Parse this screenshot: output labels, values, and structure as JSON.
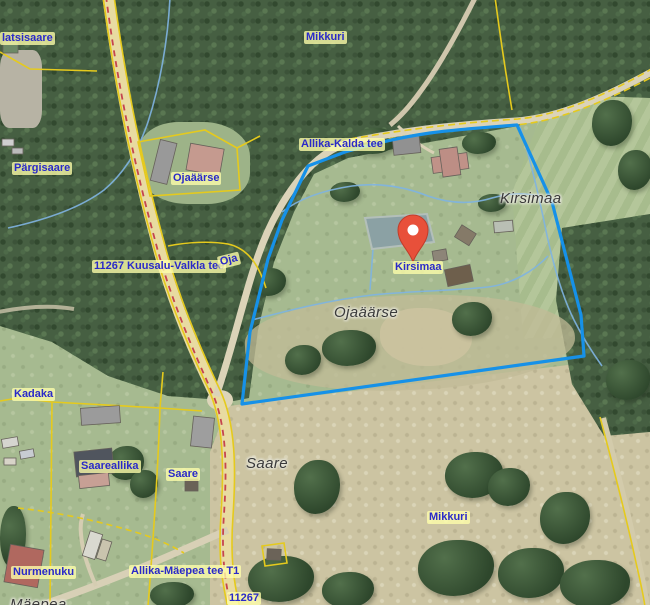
{
  "map": {
    "marker": {
      "label": "Kirsimaa",
      "color": "#e8503a"
    },
    "labels": {
      "platsisaare": "latsisaare",
      "mikkuri_top": "Mikkuri",
      "pargisaare": "Pärgisaare",
      "ojaaarse_farm": "Ojaäärse",
      "allika_kalda_tee": "Allika-Kalda tee",
      "kuusalu_valkla_tee": "11267 Kuusalu-Valkla tee",
      "oja": "Oja",
      "kirsimaa_marker": "Kirsimaa",
      "kirsimaa_place": "Kirsimaa",
      "ojaaarse_place": "Ojaäärse",
      "kadaka": "Kadaka",
      "saareallika": "Saareallika",
      "saare_small": "Saare",
      "saare_place": "Saare",
      "mikkuri_bottom": "Mikkuri",
      "nurmenuku": "Nurmenuku",
      "allika_maepea_tee": "Allika-Mäepea tee T1",
      "road_number_bottom": "11267",
      "maepea_partial": "Mäepea"
    },
    "colors": {
      "parcel_outline": "#1691e8",
      "cadastral_line": "#e5ca1d",
      "road_marking": "#c5454e",
      "stream": "#7fb4e2",
      "road_fill": "#e8dba1",
      "forest": "#465f42",
      "grass": "#a6ba90",
      "dry_field": "#ccc4a2",
      "label_blue": "#2a2ac8",
      "label_dark": "#3a3a3a",
      "marker": "#e8503a"
    }
  }
}
